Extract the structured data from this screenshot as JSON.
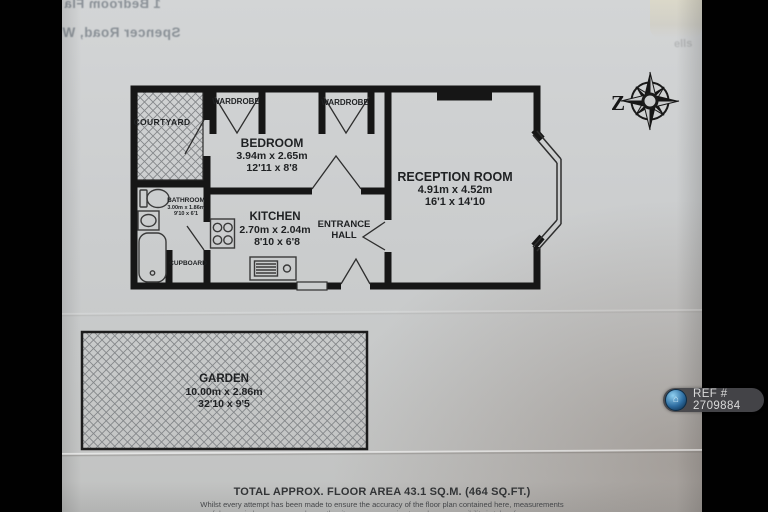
{
  "photo": {
    "bleed_line1": "1 Bedroom Fla",
    "bleed_line2": "Spencer Road, W",
    "corner_watermark": "ells"
  },
  "compass": {
    "north_letter": "Z"
  },
  "rooms": {
    "courtyard": {
      "label": "COURTYARD"
    },
    "wardrobe_left": {
      "label": "WARDROBE"
    },
    "wardrobe_right": {
      "label": "WARDROBE"
    },
    "bedroom": {
      "label": "BEDROOM",
      "metric": "3.94m x 2.65m",
      "imperial": "12'11 x 8'8"
    },
    "reception": {
      "label": "RECEPTION ROOM",
      "metric": "4.91m x 4.52m",
      "imperial": "16'1 x 14'10"
    },
    "bathroom": {
      "label": "BATHROOM",
      "metric": "3.00m x 1.86m",
      "imperial": "9'10 x 6'1"
    },
    "kitchen": {
      "label": "KITCHEN",
      "metric": "2.70m x 2.04m",
      "imperial": "8'10 x 6'8"
    },
    "entrance_hall": {
      "line1": "ENTRANCE",
      "line2": "HALL"
    },
    "cupboard": {
      "label": "CUPBOARD"
    },
    "garden": {
      "label": "GARDEN",
      "metric": "10.00m x 2.86m",
      "imperial": "32'10 x 9'5"
    }
  },
  "footer": {
    "total_area": "TOTAL APPROX. FLOOR AREA 43.1 SQ.M. (464 SQ.FT.)",
    "disclaimer1": "Whilst every attempt has been made to ensure the accuracy of the floor plan contained here, measurements",
    "disclaimer2": "of doors, windows, rooms and any other items are approximate and no responsibility is taken for any error,"
  },
  "badge": {
    "ref": "REF # 2709884",
    "icon": "⌂"
  },
  "colors": {
    "paper": "#cccecf",
    "ink": "#161616",
    "badge_bg": "#46464a",
    "badge_text": "#dadada",
    "badge_icon_blue": "#57a8dc"
  }
}
